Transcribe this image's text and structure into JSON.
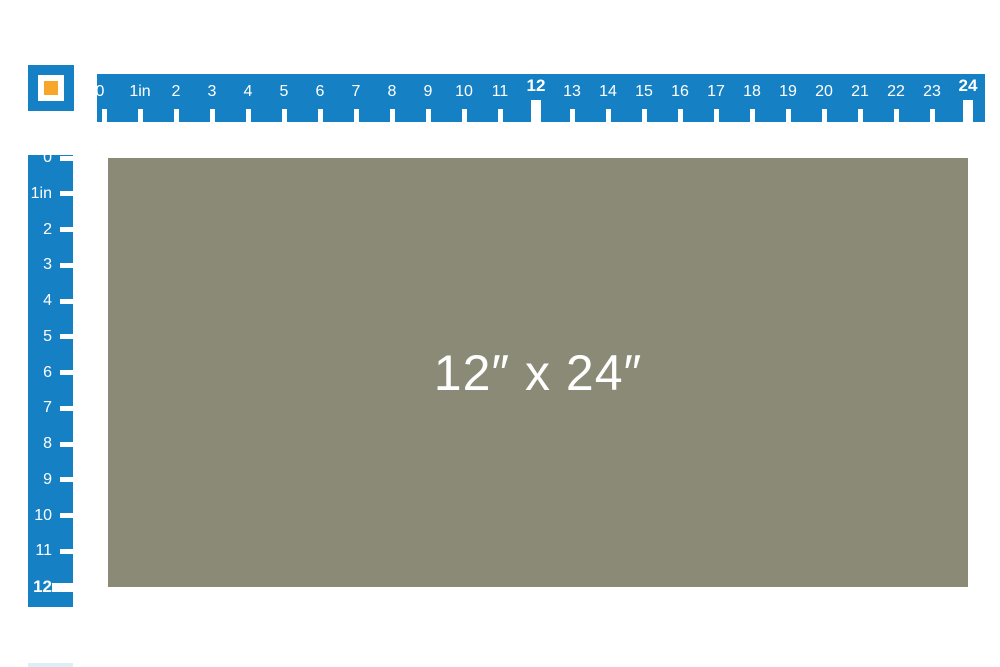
{
  "colors": {
    "ruler_blue": "#1580c4",
    "swatch_olive": "#8a8a76",
    "icon_orange": "#f7a62a",
    "tick_white": "#ffffff",
    "partial_element_blue": "#ddeef7"
  },
  "swatch": {
    "label": "12″ x 24″",
    "width_inches": 24,
    "height_inches": 12
  },
  "horizontal_ruler": {
    "marks": [
      {
        "label": "0",
        "bold": false
      },
      {
        "label": "1in",
        "bold": false
      },
      {
        "label": "2",
        "bold": false
      },
      {
        "label": "3",
        "bold": false
      },
      {
        "label": "4",
        "bold": false
      },
      {
        "label": "5",
        "bold": false
      },
      {
        "label": "6",
        "bold": false
      },
      {
        "label": "7",
        "bold": false
      },
      {
        "label": "8",
        "bold": false
      },
      {
        "label": "9",
        "bold": false
      },
      {
        "label": "10",
        "bold": false
      },
      {
        "label": "11",
        "bold": false
      },
      {
        "label": "12",
        "bold": true
      },
      {
        "label": "13",
        "bold": false
      },
      {
        "label": "14",
        "bold": false
      },
      {
        "label": "15",
        "bold": false
      },
      {
        "label": "16",
        "bold": false
      },
      {
        "label": "17",
        "bold": false
      },
      {
        "label": "18",
        "bold": false
      },
      {
        "label": "19",
        "bold": false
      },
      {
        "label": "20",
        "bold": false
      },
      {
        "label": "21",
        "bold": false
      },
      {
        "label": "22",
        "bold": false
      },
      {
        "label": "23",
        "bold": false
      },
      {
        "label": "24",
        "bold": true
      }
    ]
  },
  "vertical_ruler": {
    "marks": [
      {
        "label": "0",
        "bold": false
      },
      {
        "label": "1in",
        "bold": false
      },
      {
        "label": "2",
        "bold": false
      },
      {
        "label": "3",
        "bold": false
      },
      {
        "label": "4",
        "bold": false
      },
      {
        "label": "5",
        "bold": false
      },
      {
        "label": "6",
        "bold": false
      },
      {
        "label": "7",
        "bold": false
      },
      {
        "label": "8",
        "bold": false
      },
      {
        "label": "9",
        "bold": false
      },
      {
        "label": "10",
        "bold": false
      },
      {
        "label": "11",
        "bold": false
      },
      {
        "label": "12",
        "bold": true
      }
    ]
  }
}
